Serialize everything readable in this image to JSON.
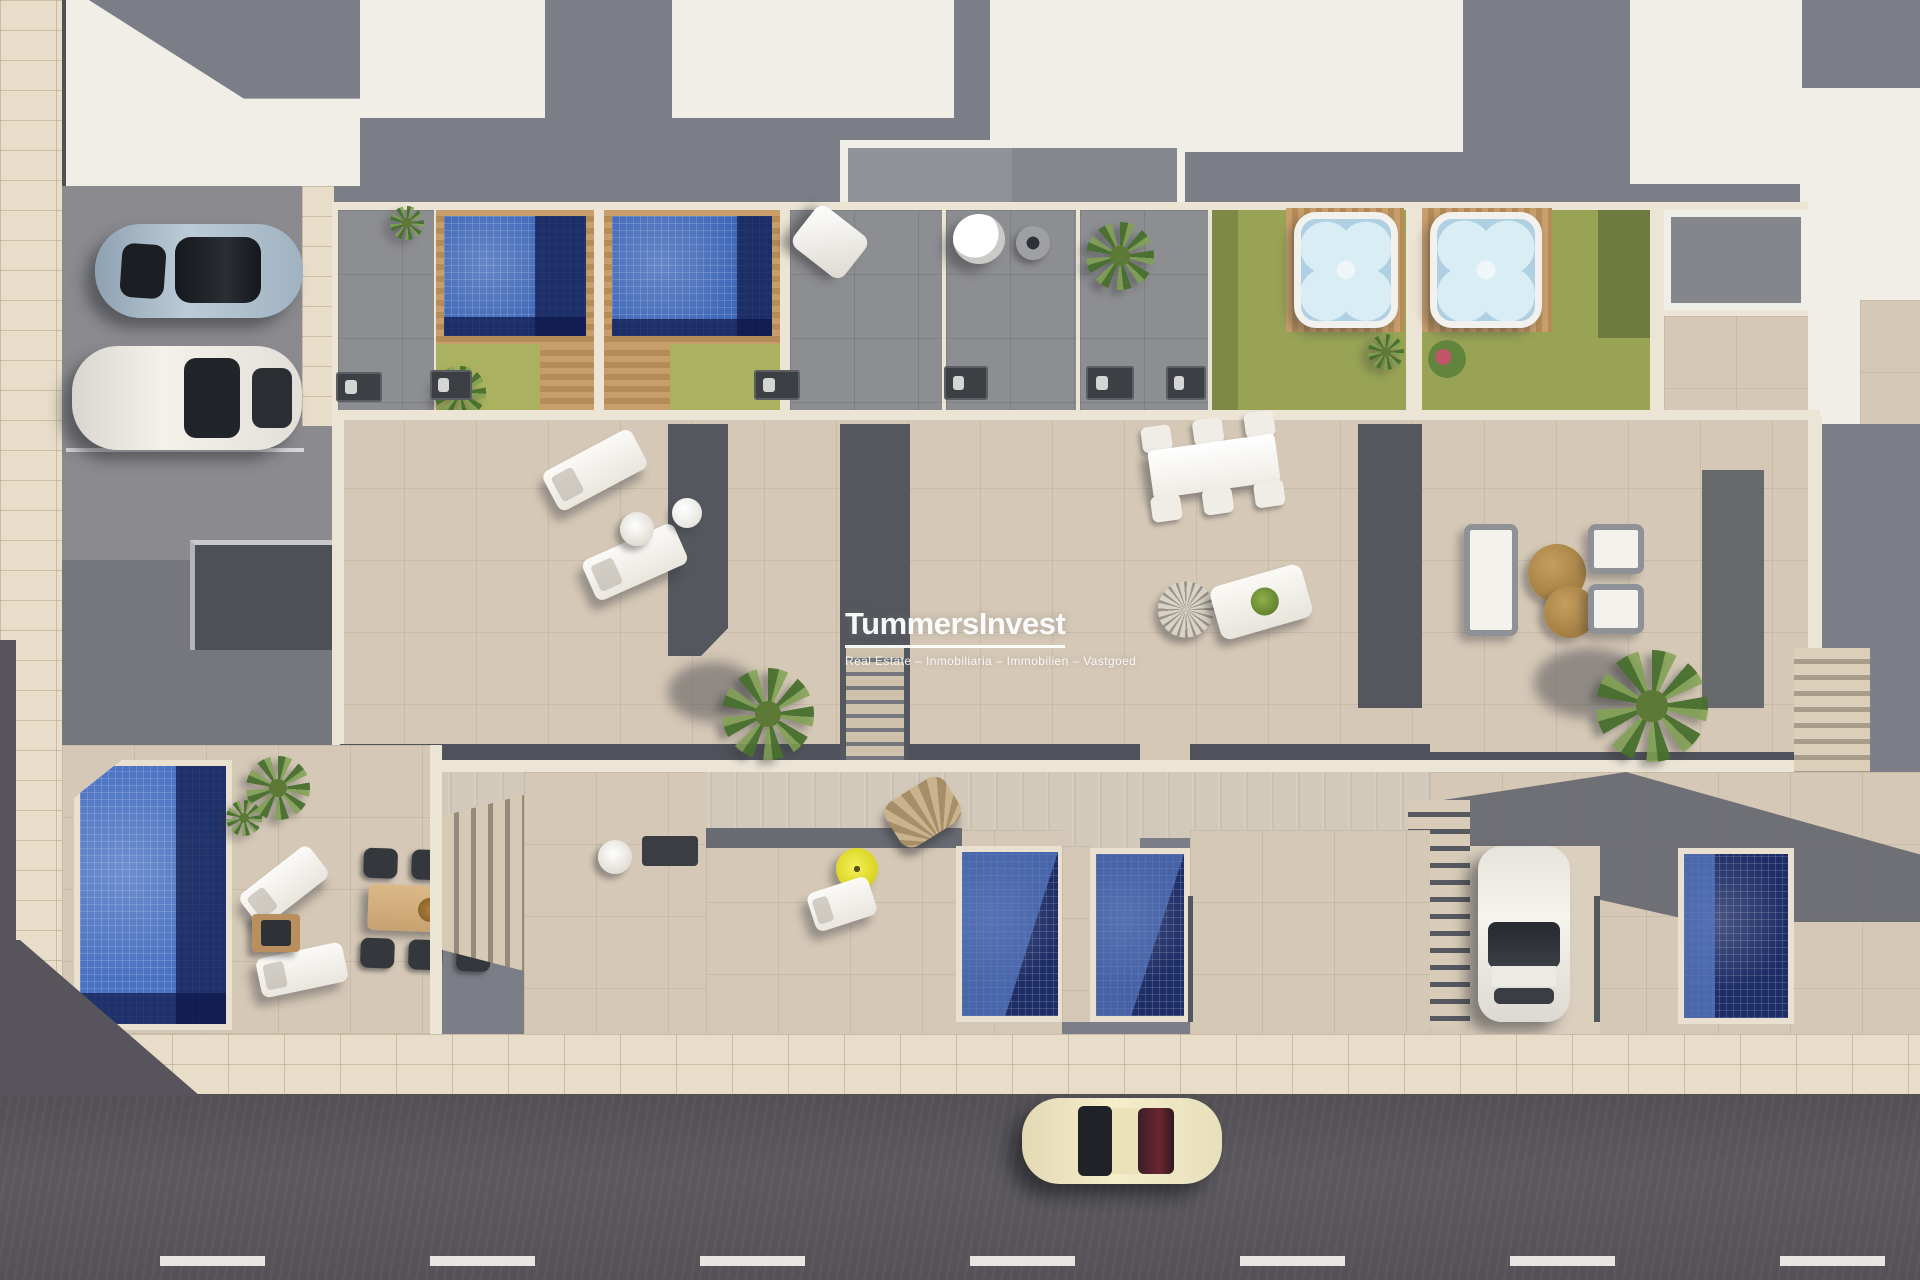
{
  "watermark": {
    "title": "TummersInvest",
    "subtitle": "Real Estate – Inmobiliaria – Immobilien – Vastgoed"
  },
  "palette": {
    "roofWhite": "#f1eee7",
    "roofShadow": "#7b7e86",
    "wallCream": "#ece5d6",
    "terraceBeige": "#d5c8b6",
    "patioGray": "#8d8e92",
    "darkWall": "#54575e",
    "poolBlue": "#3f68b8",
    "poolNavy": "#1d2d66",
    "lawnGreen": "#aab25f",
    "lawnOlive": "#98a355",
    "woodTan": "#c0935f",
    "jacuzziBlue": "#aed0e2",
    "asphalt": "#8b8b8f",
    "road": "#57555b",
    "sidewalk": "#e8ddc9",
    "carSilver": "#a9bcca",
    "carWhite": "#edeae3",
    "carCream": "#eee3bd",
    "accentYellow": "#e8e032",
    "tableTan": "#b08a4c"
  },
  "scene": {
    "type": "aerial-3d-render",
    "subject": "Row of modern townhouses seen from above: roof terraces with pools and jacuzzis, tiled terraces with outdoor furniture, ground-floor patios with plunge pools, private parking and a street",
    "vehicles": [
      "silver-blue sports car in parking",
      "white sedan in parking",
      "white hatchback in driveway",
      "cream classic coupe on street"
    ],
    "water_features": {
      "rooftop_pools": 2,
      "jacuzzis": 2,
      "garden_pool": 1,
      "plunge_pools": 3
    }
  }
}
